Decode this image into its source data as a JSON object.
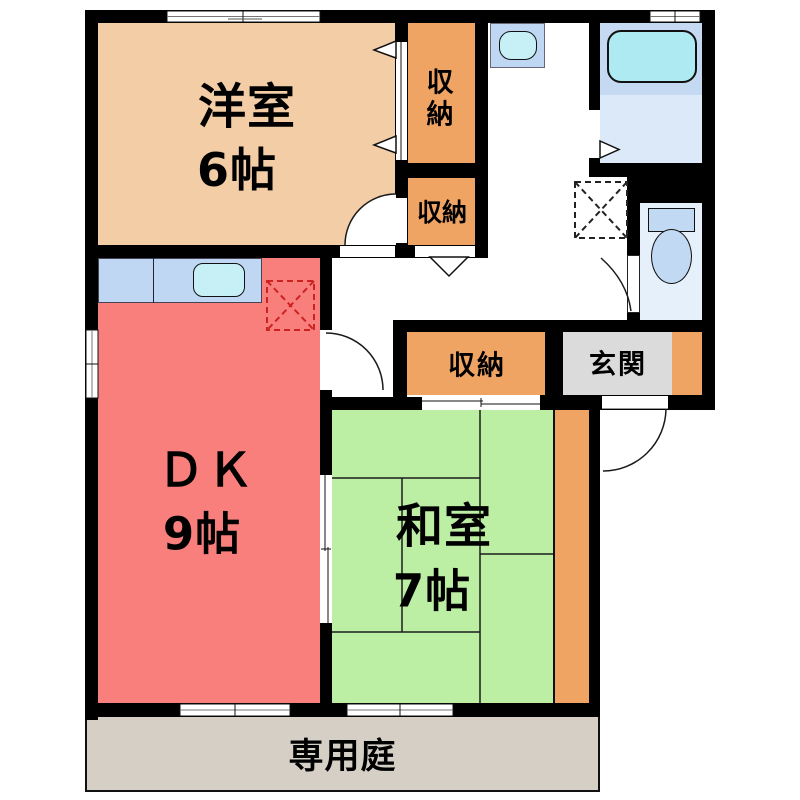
{
  "title": "賃貸間取り図 2DK",
  "rooms": {
    "yoshitsu": {
      "label": "洋室",
      "size": "6帖"
    },
    "dk": {
      "label": "ＤＫ",
      "size": "9帖"
    },
    "washitsu": {
      "label": "和室",
      "size": "7帖"
    },
    "closet_upper": {
      "label": "収納"
    },
    "closet_lower": {
      "label": "収納"
    },
    "closet_middle": {
      "label": "収納"
    },
    "genkan": {
      "label": "玄関"
    },
    "garden": {
      "label": "専用庭"
    }
  },
  "fixtures": {
    "bathtub": "bathtub",
    "toilet": "toilet",
    "kitchen_sink": "kitchen-counter-sink",
    "wash_basin": "wash-basin",
    "washing_machine_space": "washing-machine-space-dashed",
    "refrigerator_space": "refrigerator-space-dashed"
  },
  "colors": {
    "wall": "#000000",
    "yoshitsu": "#F2CDA6",
    "closet": "#F0A464",
    "dk": "#F97F7D",
    "washitsu": "#BCEEA4",
    "genkan": "#DBDBDB",
    "garden": "#D5CFC5",
    "counter": "#BFD7F2",
    "sink": "#C6F0F6",
    "bath_zone": "#C5DAF2",
    "bath_floor": "#DCE9F8",
    "bathtub": "#AEEAF2",
    "toilet_room": "#E6F0FB",
    "toilet_fixture": "#C2D9F3",
    "fridge_line": "#CC2222"
  }
}
